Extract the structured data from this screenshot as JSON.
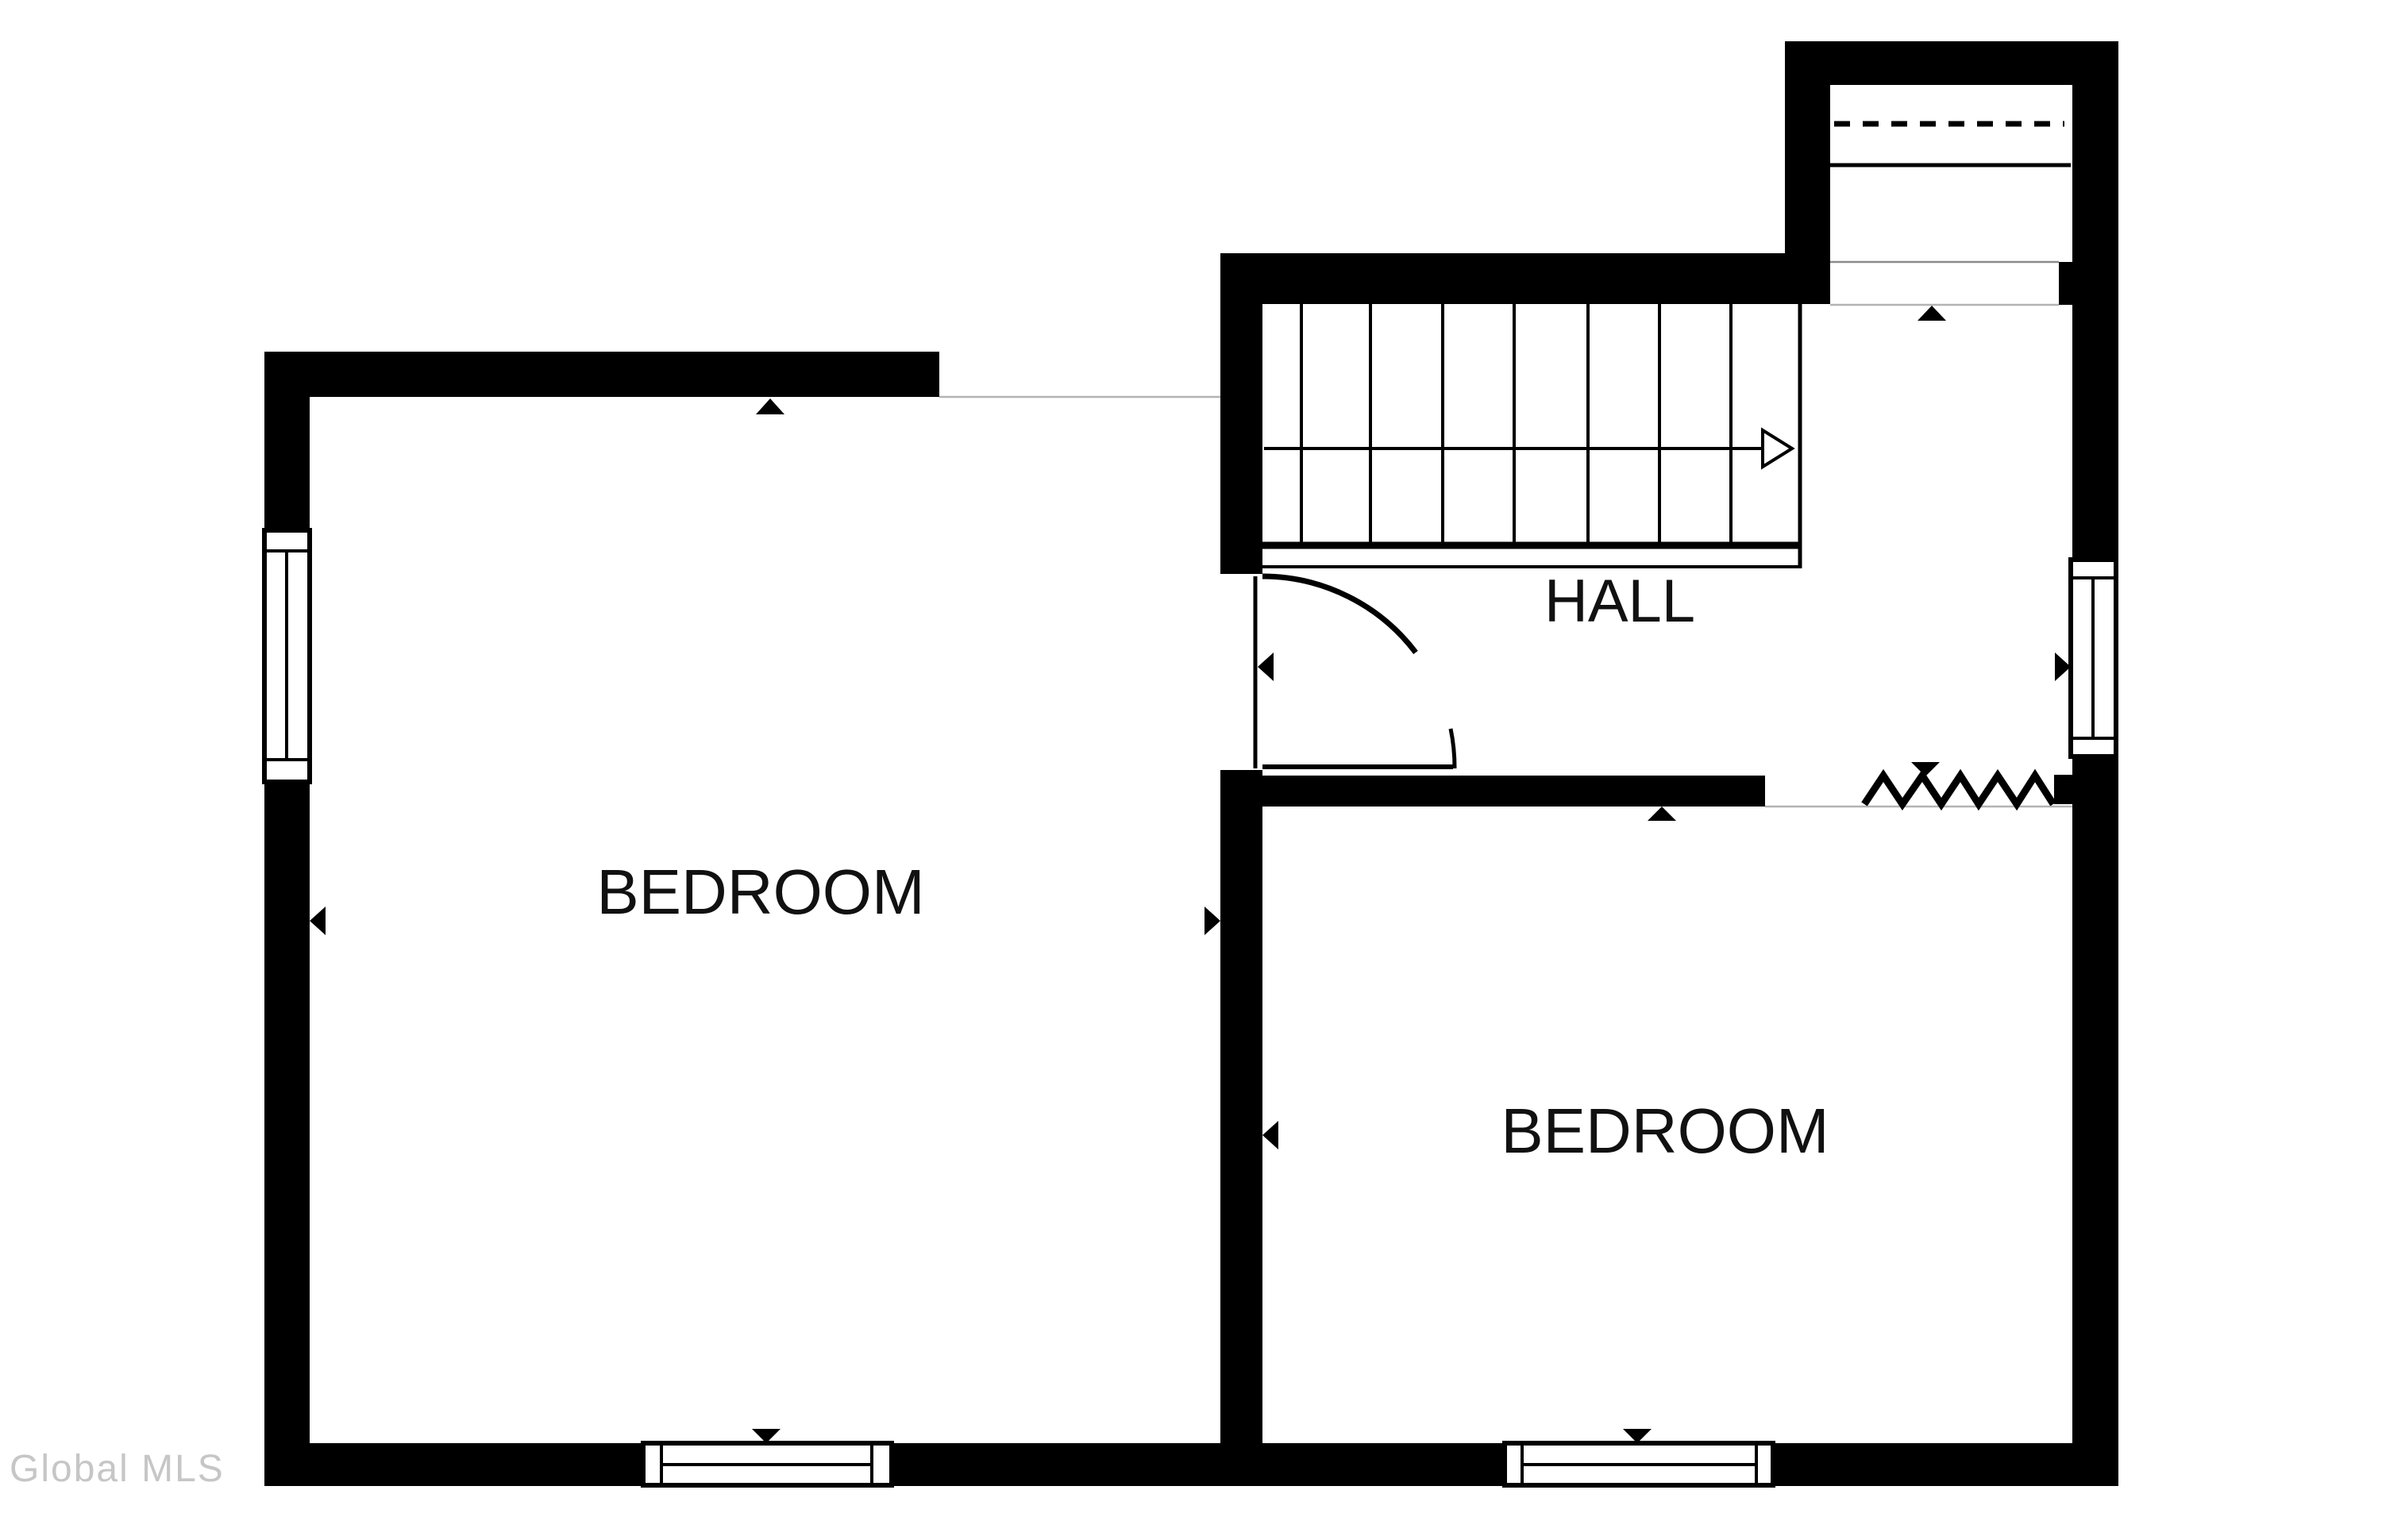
{
  "document": {
    "kind": "floor-plan",
    "background": "#ffffff"
  },
  "colors": {
    "wall": "#000000",
    "thin_line": "#b3b3b3",
    "floor_edge_line": "#8a8a8a",
    "label_text": "#111111",
    "watermark_text": "#c6c6c6"
  },
  "labels": {
    "bedroom_left": "BEDROOM",
    "bedroom_right": "BEDROOM",
    "hall": "HALL",
    "watermark": "Global MLS"
  },
  "plan": {
    "rooms": [
      {
        "name": "bedroom-left",
        "label": "BEDROOM"
      },
      {
        "name": "bedroom-right",
        "label": "BEDROOM"
      },
      {
        "name": "hall",
        "label": "HALL"
      },
      {
        "name": "closet-top-right",
        "label": ""
      }
    ],
    "features": [
      "staircase-with-direction-arrow",
      "door-swing-arc-into-hall",
      "double-hung-window-left-wall",
      "double-hung-window-right-wall",
      "double-hung-window-bottom-left",
      "double-hung-window-bottom-right",
      "dashed-closet-shelf-line",
      "zigzag-open-edge",
      "wall-direction-markers"
    ],
    "marker_count": 11
  }
}
